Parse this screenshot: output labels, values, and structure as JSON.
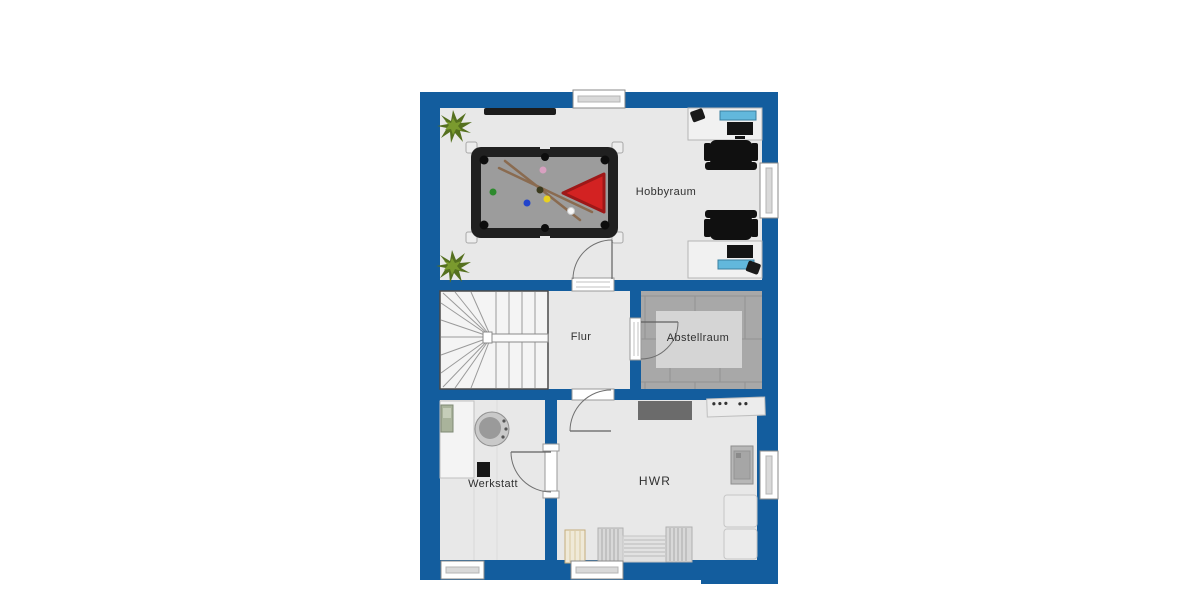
{
  "plan": {
    "type": "floorplan-basement",
    "rooms": [
      {
        "id": "hobbyraum",
        "name": "Hobbyraum"
      },
      {
        "id": "flur",
        "name": "Flur"
      },
      {
        "id": "abstellraum",
        "name": "Abstellraum"
      },
      {
        "id": "werkstatt",
        "name": "Werkstatt"
      },
      {
        "id": "hwr",
        "name": "HWR"
      }
    ],
    "colors": {
      "wall": "#135d9e",
      "floor": "#e8e8e8",
      "tile_floor": "#a8a8a8",
      "rug": "#d5d5d5",
      "stair_tread": "#f4f4f4",
      "billiard_frame": "#202020",
      "billiard_felt": "#9c9c9c",
      "rack_triangle_red": "#d32222",
      "cue_brown": "#8a6b50",
      "plant_green": "#55701f",
      "laptop_blue": "#62b8dc",
      "shelf_dark": "#6b6b6b",
      "chair_black": "#101010"
    },
    "furniture": [
      "billiard-table",
      "pool-cues",
      "billiard-balls",
      "rack-triangle",
      "wall-shelf",
      "plant",
      "desk",
      "office-chair",
      "monitor",
      "phone",
      "winder-staircase",
      "rug",
      "workbench",
      "bench-machine",
      "storage-shelf",
      "control-unit",
      "boiler-cabinet",
      "appliance",
      "radiator",
      "drying-rack",
      "window",
      "door"
    ]
  }
}
